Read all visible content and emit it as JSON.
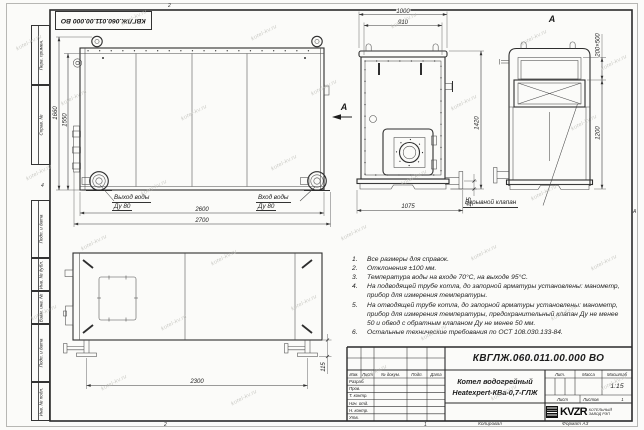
{
  "watermark": "kotel-kv.ru",
  "doc_number": "КВГЛЖ.060.011.00.000 ВО",
  "margins": {
    "perv_primen": "Перв. примен.",
    "sprav_no": "Справ. №",
    "podp_data1": "Подп. и дата",
    "inv_dubl": "Инв. № дубл.",
    "vzam_inv": "Взам. инв. №",
    "podp_data2": "Подп. и дата",
    "inv_podl": "Инв. № подл.",
    "fold_top": "2",
    "fold_bottom": "2",
    "fold_bottom2": "1",
    "zone_left": "4",
    "zone_right": "А"
  },
  "views": {
    "side": {
      "dim_2600": "2600",
      "dim_2700": "2700",
      "dim_1660": "1660",
      "dim_1550": "1550",
      "outlet_label": "Выход воды",
      "outlet_dn": "Ду 80",
      "inlet_label": "Вход воды",
      "inlet_dn": "Ду 80"
    },
    "front": {
      "dim_1000": "1000",
      "dim_910": "910",
      "dim_1420": "1420",
      "dim_1075": "1075",
      "dim_115": "115",
      "arrow_letter": "А"
    },
    "view_a": {
      "title": "А",
      "dim_valve": "200×500",
      "dim_1200": "1200",
      "valve_label": "Взрывной клапан"
    },
    "bottom": {
      "dim_2300": "2300",
      "dim_115": "115"
    }
  },
  "notes": {
    "items": [
      {
        "n": "1.",
        "text": "Все размеры для справок."
      },
      {
        "n": "2.",
        "text": "Отклонения ±100 мм."
      },
      {
        "n": "3.",
        "text": "Температура воды на входе 70°С, на выходе 95°С."
      },
      {
        "n": "4.",
        "text": "На подводящей трубе котла, до запорной арматуры установлены: манометр, прибор для измерения температуры."
      },
      {
        "n": "5.",
        "text": "На отводящей трубе котла, до запорной арматуры установлены: манометр, прибор для измерения температуры, предохранительный клапан Ду не менее 50 и обвод с обратным клапаном Ду не менее 50 мм."
      },
      {
        "n": "6.",
        "text": "Остальные технические требования по ОСТ 108.030.133-84."
      }
    ]
  },
  "title_block": {
    "name_line1": "Котел водогрейный",
    "name_line2": "Heatexpert-КВа-0,7-ГЛЖ",
    "col_izm": "Изм.",
    "col_list": "Лист",
    "col_doc": "№ докум.",
    "col_podp": "Подп.",
    "col_data": "Дата",
    "rows": [
      "Разраб.",
      "Пров.",
      "Т. контр.",
      "Нач. отд.",
      "Н. контр.",
      "Утв."
    ],
    "lit": "Лит.",
    "massa": "Масса",
    "masshtab": "Масштаб",
    "scale": "1:15",
    "list_label": "Лист",
    "listov_label": "Листов",
    "listov_value": "1",
    "logo": "KVZR",
    "logo_line1": "КОТЕЛЬНЫЙ",
    "logo_line2": "ЗАВОД РЭП",
    "kopiroval": "Копировал",
    "format": "Формат А3"
  }
}
